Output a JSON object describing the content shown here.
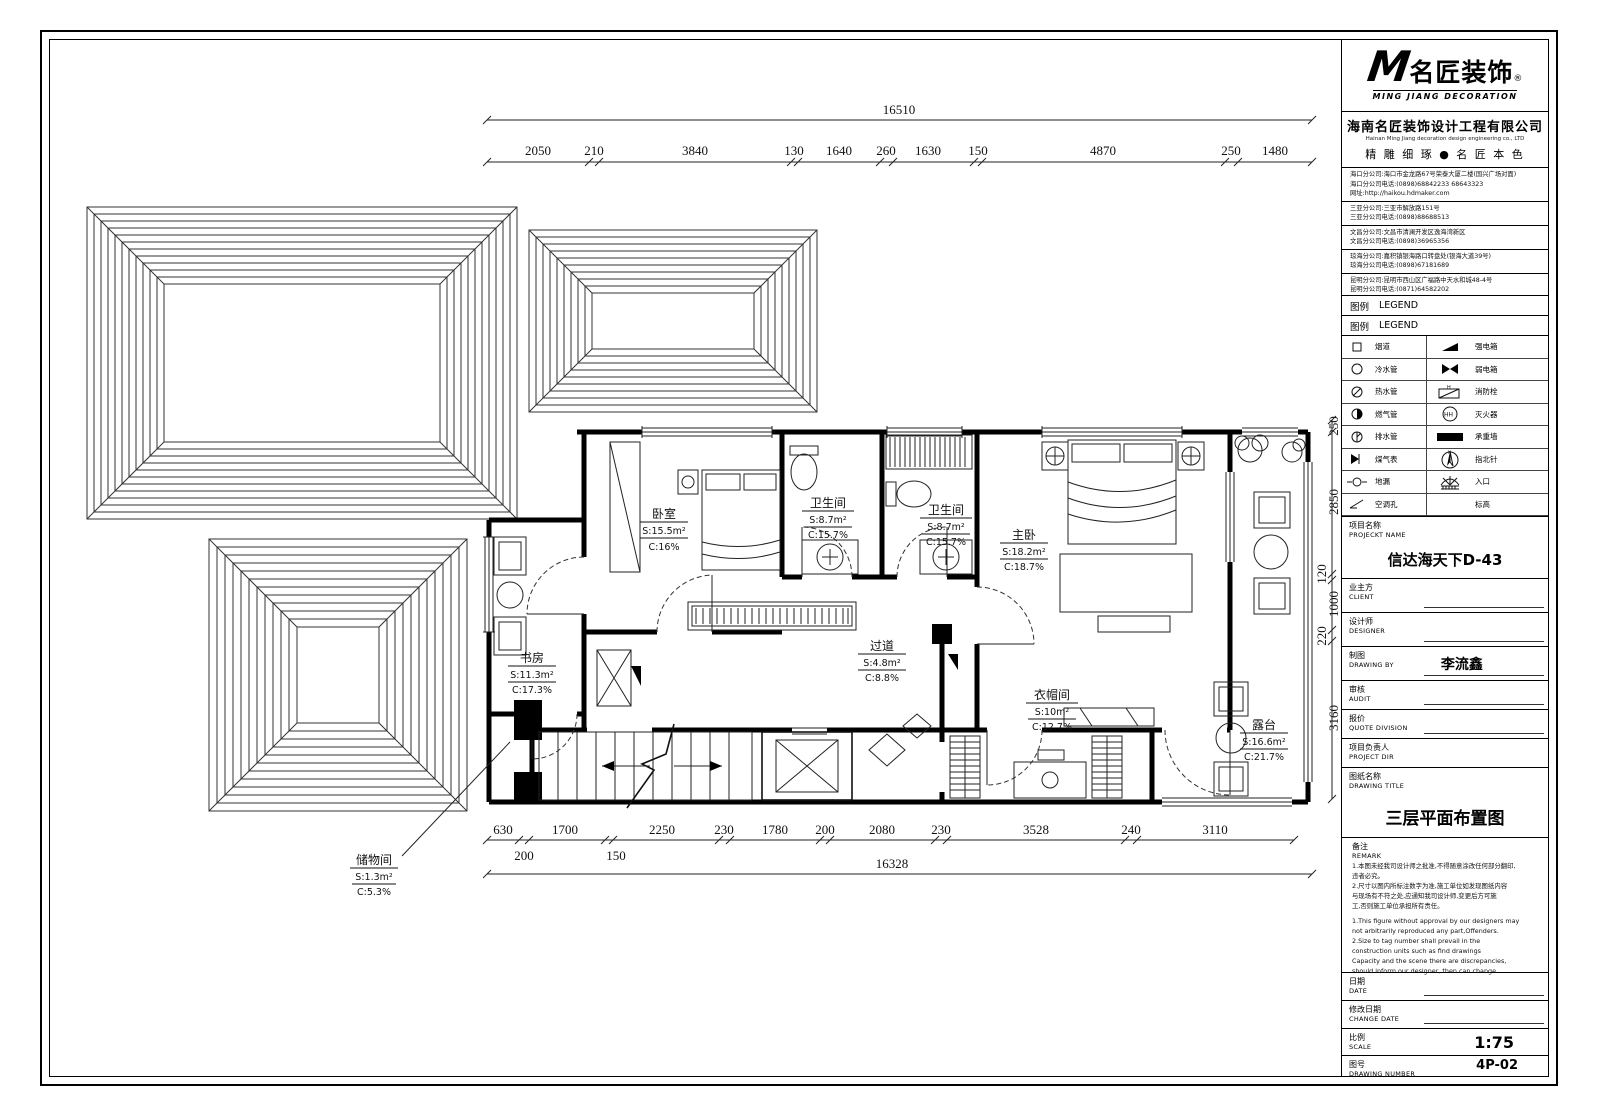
{
  "title_block": {
    "logo": {
      "m": "M",
      "cn": "名匠装饰",
      "reg": "®",
      "en": "MING JIANG DECORATION"
    },
    "company": {
      "cn": "海南名匠装饰设计工程有限公司",
      "en": "Hainan Ming Jiang decoration design engineering co., LTD",
      "slogan": "精 雕 细 琢 ● 名 匠 本 色"
    },
    "branch_groups": [
      [
        "海口分公司:海口市金龙路67号荣泰大厦二楼(国兴广场对面)",
        "海口分公司电话:(0898)68842233  68643323",
        "网址:http://haikou.hdmaker.com"
      ],
      [
        "三亚分公司:三亚市解放路151号",
        "三亚分公司电话:(0898)88688513"
      ],
      [
        "文昌分公司:文昌市清澜开发区逸海湾新区",
        "文昌分公司电话:(0898)36965356"
      ],
      [
        "琼海分公司:嘉积镇银海路口转盘处(银海大道39号)",
        "琼海分公司电话:(0898)67181689"
      ],
      [
        "昆明分公司:昆明市西山区广福路中天水和城48-4号",
        "昆明分公司电话:(0871)64582202"
      ]
    ],
    "legend": {
      "label_cn": "图例",
      "label_en": "LEGEND",
      "rows": [
        {
          "left": "烟道",
          "right": "强电箱"
        },
        {
          "left": "冷水管",
          "right": "弱电箱"
        },
        {
          "left": "热水管",
          "right": "消防栓"
        },
        {
          "left": "燃气管",
          "right": "灭火器"
        },
        {
          "left": "排水管",
          "right": "承重墙"
        },
        {
          "left": "煤气表",
          "right": "指北针"
        },
        {
          "left": "地漏",
          "right": "入口"
        },
        {
          "left": "空调孔",
          "right": "标高"
        }
      ]
    },
    "fields": {
      "project": {
        "cn": "项目名称",
        "en": "PROJECKT NAME",
        "value": "信达海天下D-43"
      },
      "client": {
        "cn": "业主方",
        "en": "CLIENT",
        "value": ""
      },
      "designer": {
        "cn": "设计师",
        "en": "DESIGNER",
        "value": ""
      },
      "drawing_by": {
        "cn": "制图",
        "en": "DRAWING BY",
        "value": "李流鑫"
      },
      "audit": {
        "cn": "审核",
        "en": "AUDIT",
        "value": ""
      },
      "quote": {
        "cn": "报价",
        "en": "QUOTE DIVISION",
        "value": ""
      },
      "director": {
        "cn": "项目负责人",
        "en": "PROJECT DIR",
        "value": ""
      },
      "title": {
        "cn": "图纸名称",
        "en": "DRAWING TITLE",
        "value": "三层平面布置图"
      },
      "date": {
        "cn": "日期",
        "en": "DATE",
        "value": ""
      },
      "change_date": {
        "cn": "修改日期",
        "en": "CHANGE DATE",
        "value": ""
      },
      "scale": {
        "cn": "比例",
        "en": "SCALE",
        "value": "1:75"
      },
      "number": {
        "cn": "图号",
        "en": "DRAWING NUMBER",
        "value": "4P-02"
      }
    },
    "remark": {
      "label_cn": "备注",
      "label_en": "REMARK",
      "lines_cn": [
        "1.本图未经我司设计师之批准,不得随意涂改任何部分翻印,",
        "  违者必究。",
        "2.尺寸以图内所标注数字为准,施工单位如发现图纸内容",
        "  与现场有不符之处,应通知我司设计师,变更后方可施",
        "  工,否则施工单位承担所有责任。"
      ],
      "lines_en": [
        "1.This figure without approval by our designers may",
        "  not arbitrarily reproduced any part,Offenders.",
        "2.Size to tag number shall prevail in the",
        "  construction units such as find drawings",
        "  Capacity and the scene there are discrepancies,",
        "  should inform our designer, then can change."
      ]
    }
  },
  "plan": {
    "dims_top": {
      "total": "16510",
      "segments": [
        "2050",
        "210",
        "3840",
        "130",
        "1640",
        "260",
        "1630",
        "150",
        "4870",
        "250",
        "1480"
      ]
    },
    "dims_bottom": {
      "total": "16328",
      "segments": [
        "630",
        "1700",
        "2250",
        "230",
        "1780",
        "200",
        "2080",
        "230",
        "3528",
        "240",
        "3110"
      ],
      "sub": [
        "200",
        "150"
      ]
    },
    "dims_right": [
      "250",
      "2850",
      "120",
      "1000",
      "220",
      "3160"
    ],
    "rooms": [
      {
        "name": "卧室",
        "area": "S:15.5m²",
        "ratio": "C:16%"
      },
      {
        "name": "卫生间",
        "area": "S:8.7m²",
        "ratio": "C:15.7%"
      },
      {
        "name": "卫生间",
        "area": "S:8.7m²",
        "ratio": "C:15.7%"
      },
      {
        "name": "主卧",
        "area": "S:18.2m²",
        "ratio": "C:18.7%"
      },
      {
        "name": "书房",
        "area": "S:11.3m²",
        "ratio": "C:17.3%"
      },
      {
        "name": "过道",
        "area": "S:4.8m²",
        "ratio": "C:8.8%"
      },
      {
        "name": "衣帽间",
        "area": "S:10m²",
        "ratio": "C:12.7%"
      },
      {
        "name": "露台",
        "area": "S:16.6m²",
        "ratio": "C:21.7%"
      },
      {
        "name": "储物间",
        "area": "S:1.3m²",
        "ratio": "C:5.3%"
      }
    ]
  }
}
